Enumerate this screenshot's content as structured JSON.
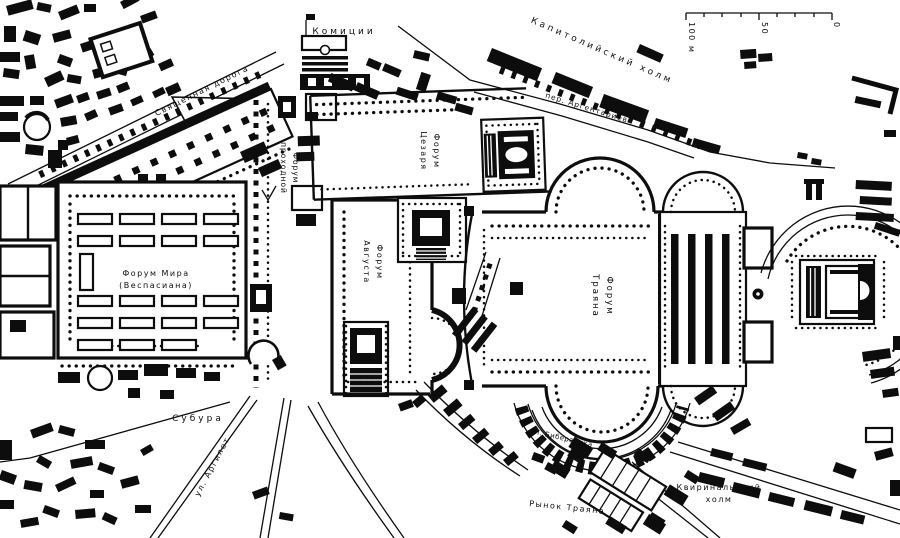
{
  "colors": {
    "ink": "#0d0d0d",
    "paper": "#ffffff"
  },
  "labels": {
    "sacred_road": "Священная дорога",
    "comitium": "Комиции",
    "capitoline_hill": "Капитолийский холм",
    "argentariev_lane": "пер. Аргентариев",
    "forum_pacis_1": "Форум Мира",
    "forum_pacis_2": "(Веспасиана)",
    "forum_transitorium_1": "Форум",
    "forum_transitorium_2": "проходной",
    "forum_caesar_1": "Форум",
    "forum_caesar_2": "Цезаря",
    "forum_augustus_1": "Форум",
    "forum_augustus_2": "Августа",
    "forum_trajan_1": "Форум",
    "forum_trajan_2": "Траяна",
    "subura": "Субура",
    "argiletum_street": "ул. Аргилет",
    "biberatica_street": "ул. Бибератика",
    "trajan_market": "Рынок Траяна",
    "quirinal_hill_1": "Квиринальский",
    "quirinal_hill_2": "холм"
  },
  "scale_bar": {
    "ticks": [
      "100 м",
      "50",
      "0"
    ]
  }
}
